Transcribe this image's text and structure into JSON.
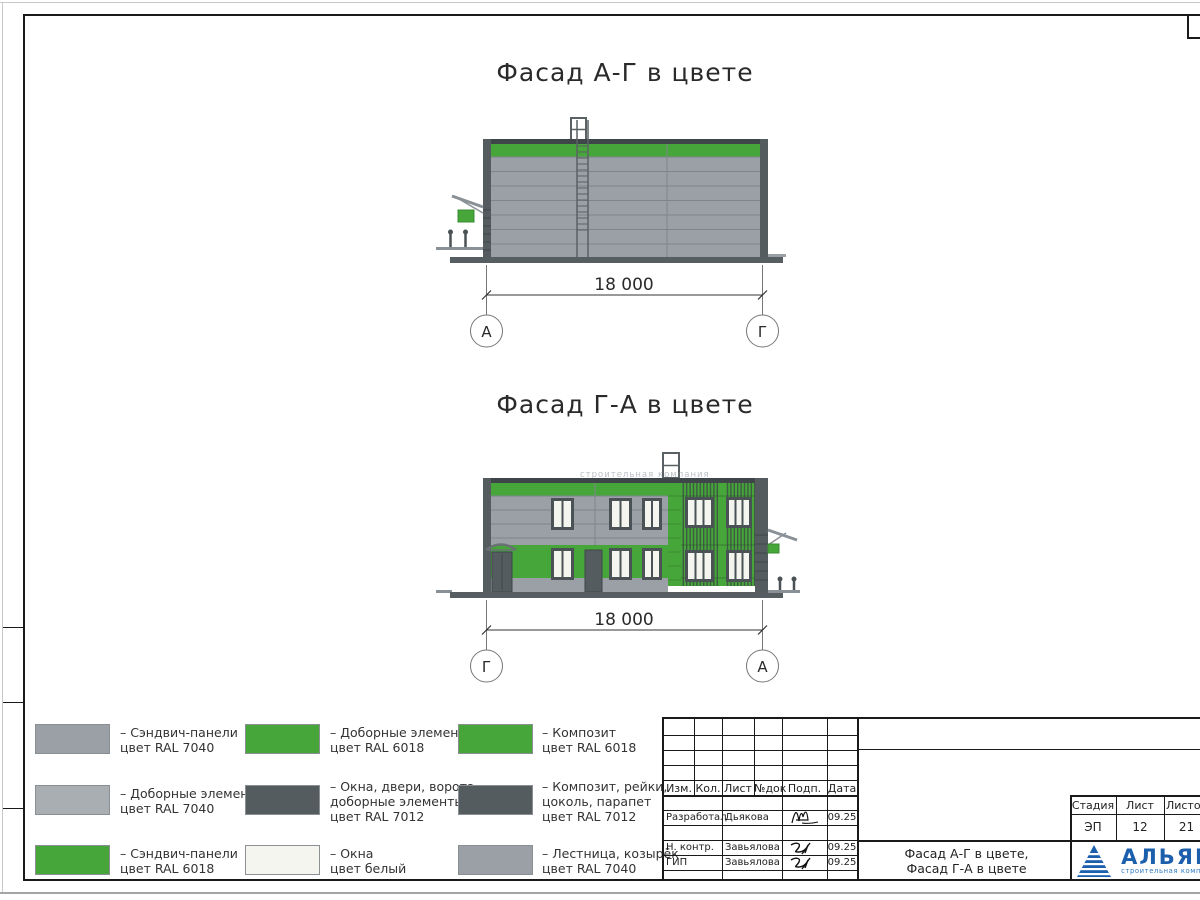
{
  "palette": {
    "green_ral6018": "#46A63A",
    "gray_ral7040": "#9AA0A5",
    "gray_light_ral7040": "#A9AEB3",
    "dark_ral7012": "#545C5F",
    "frame_dark": "#4A5255",
    "window_white": "#F3F5EE",
    "ladder_gray": "#8A9196",
    "logo_blue": "#1C5FAC"
  },
  "facades": [
    {
      "title": "Фасад А-Г в цвете",
      "dimension": "18 000",
      "axis_left": "А",
      "axis_right": "Г"
    },
    {
      "title": "Фасад Г-А в цвете",
      "dimension": "18 000",
      "axis_left": "Г",
      "axis_right": "А",
      "watermark": "строительная компания"
    }
  ],
  "legend": {
    "items": [
      {
        "color": "#9AA0A5",
        "label1": "– Сэндвич-панели",
        "label2": "цвет RAL 7040",
        "label3": ""
      },
      {
        "color": "#A9AEB3",
        "label1": "– Доборные элементы",
        "label2": "цвет RAL 7040",
        "label3": ""
      },
      {
        "color": "#46A63A",
        "label1": "– Сэндвич-панели",
        "label2": "цвет RAL 6018",
        "label3": ""
      },
      {
        "color": "#46A63A",
        "label1": "– Доборные элементы",
        "label2": "цвет RAL 6018",
        "label3": ""
      },
      {
        "color": "#545C5F",
        "label1": "– Окна, двери, ворота,",
        "label2": "доборные элементы",
        "label3": "цвет RAL 7012"
      },
      {
        "color": "#F3F5EE",
        "label1": "– Окна",
        "label2": "цвет белый",
        "label3": ""
      },
      {
        "color": "#46A63A",
        "label1": "– Композит",
        "label2": "цвет RAL 6018",
        "label3": ""
      },
      {
        "color": "#545C5F",
        "label1": "– Композит, рейки,",
        "label2": "цоколь, парапет",
        "label3": "цвет RAL 7012"
      },
      {
        "color": "#9AA0A5",
        "label1": "– Лестница, козырёк",
        "label2": "цвет RAL 7040",
        "label3": ""
      }
    ]
  },
  "titleblock": {
    "rev_header": {
      "izm": "Изм.",
      "kol": "Кол.",
      "list": "Лист",
      "ndok": "№док",
      "podp": "Подп.",
      "data": "Дата"
    },
    "staff": [
      {
        "role": "Разработал",
        "name": "Дьякова",
        "date": "09.25"
      },
      {
        "role": "Н. контр.",
        "name": "Завьялова",
        "date": "09.25"
      },
      {
        "role": "ГИП",
        "name": "Завьялова",
        "date": "09.25"
      }
    ],
    "doc_title_line1": "Фасад А-Г в цвете,",
    "doc_title_line2": "Фасад Г-А в цвете",
    "stage_header": {
      "stage": "Стадия",
      "sheet": "Лист",
      "sheets": "Листов"
    },
    "stage_values": {
      "stage": "ЭП",
      "sheet": "12",
      "sheets": "21"
    },
    "logo": {
      "name": "АЛЬЯНС",
      "subtitle": "строительная компания"
    }
  }
}
